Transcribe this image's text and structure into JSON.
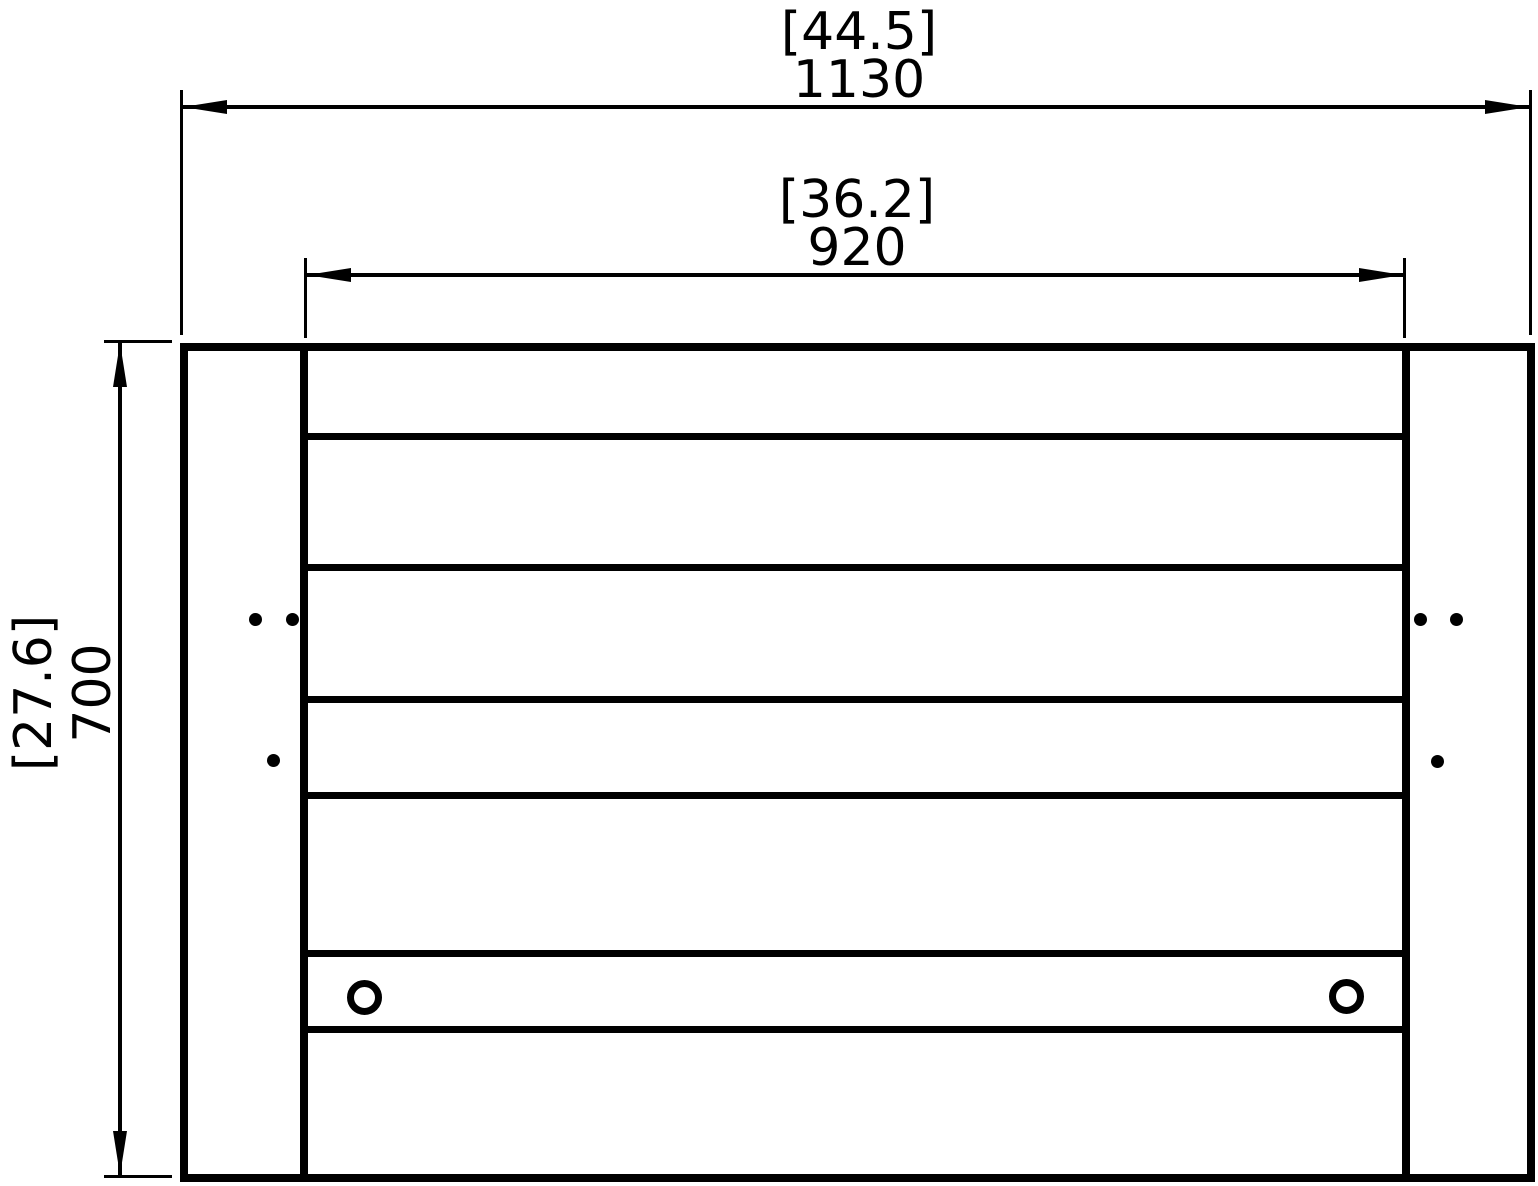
{
  "dimensions": {
    "overall_width": {
      "inches": "[44.5]",
      "mm": "1130"
    },
    "inner_width": {
      "inches": "[36.2]",
      "mm": "920"
    },
    "height": {
      "inches": "[27.6]",
      "mm": "700"
    }
  },
  "colors": {
    "line": "#000000",
    "background": "#ffffff"
  }
}
